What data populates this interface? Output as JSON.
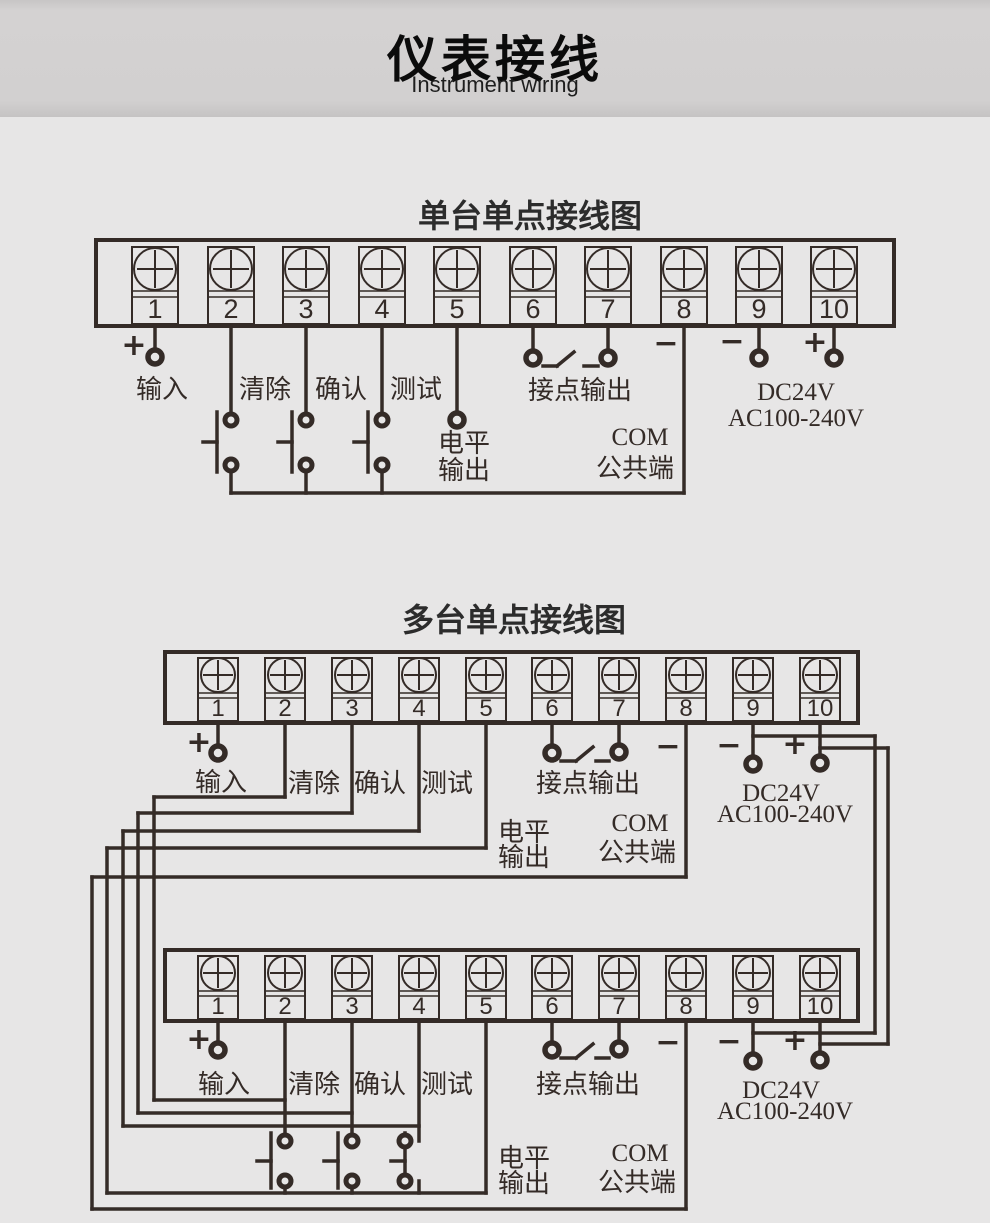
{
  "header": {
    "title": "仪表接线",
    "subtitle": "Instrument wiring"
  },
  "sections": [
    {
      "title": "单台单点接线图"
    },
    {
      "title": "多台单点接线图"
    }
  ],
  "terminal_numbers": [
    "1",
    "2",
    "3",
    "4",
    "5",
    "6",
    "7",
    "8",
    "9",
    "10"
  ],
  "labels": {
    "plus": "+",
    "minus": "−",
    "input": "输入",
    "clear": "清除",
    "confirm": "确认",
    "test": "测试",
    "level1": "电平",
    "level2": "输出",
    "contact": "接点输出",
    "com": "COM",
    "common": "公共端",
    "dc": "DC24V",
    "ac": "AC100-240V"
  }
}
